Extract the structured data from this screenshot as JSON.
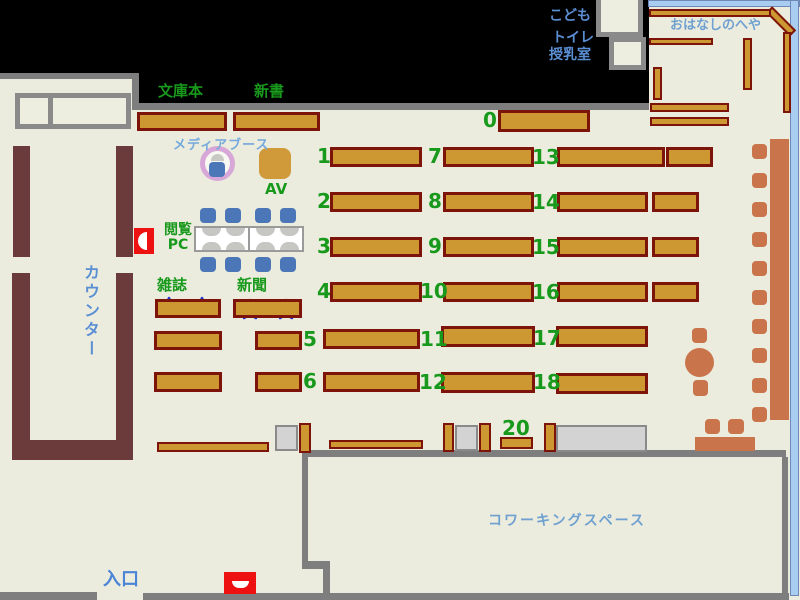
{
  "title": "Library floor map",
  "labels": {
    "bunkobon": "文庫本",
    "shinsho": "新書",
    "media_booth": "メディアブース",
    "av": "AV",
    "reading_pc": "閲覧\nPC",
    "magazines": "雑誌",
    "newspapers": "新聞",
    "counter": "カウンター",
    "entrance": "入口",
    "kids": "こども",
    "toilet": "トイレ",
    "nursing_room": "授乳室",
    "story_room": "おはなしのへや",
    "coworking_space": "コワーキングスペース"
  },
  "shelf_numbers": [
    "0",
    "1",
    "2",
    "3",
    "4",
    "5",
    "6",
    "7",
    "8",
    "9",
    "10",
    "11",
    "12",
    "13",
    "14",
    "15",
    "16",
    "17",
    "18",
    "20"
  ],
  "colors": {
    "background": "#EBECDE",
    "shelf_fill": "#CD9832",
    "shelf_border": "#7D1409",
    "counter_brown": "#6B3A3A",
    "wall_gray": "#7E7E7E",
    "blue_text": "#5B8FD4",
    "light_blue_text": "#74A9DC",
    "green_text": "#18991C",
    "furniture_orange": "#C9744A",
    "chair_blue": "#4B77B9",
    "room_wall_blue": "#A9CDF1",
    "gate_red": "#EE1111",
    "media_ring_pink": "#D7A8D7",
    "star_fill": "#E85050",
    "star_border": "#1F35D0"
  }
}
